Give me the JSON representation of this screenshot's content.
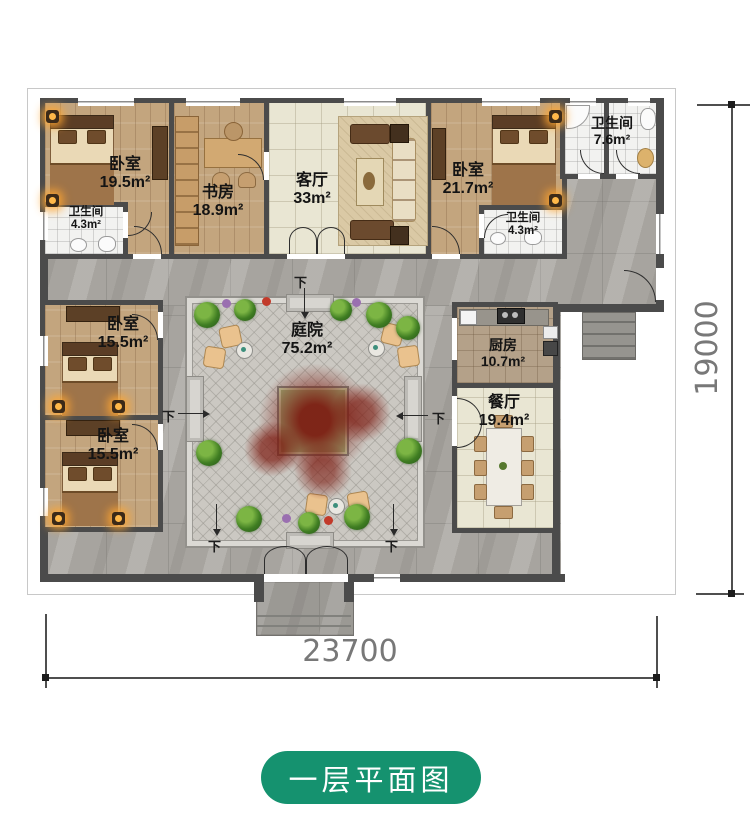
{
  "title_badge": {
    "text": "一层平面图"
  },
  "dimensions": {
    "width_label": "23700",
    "height_label": "19000"
  },
  "step_label": "下",
  "rooms": {
    "bedroom_nw": {
      "name": "卧室",
      "area": "19.5m²"
    },
    "bath_nw": {
      "name": "卫生间",
      "area": "4.3m²"
    },
    "study": {
      "name": "书房",
      "area": "18.9m²"
    },
    "living": {
      "name": "客厅",
      "area": "33m²"
    },
    "bedroom_ne": {
      "name": "卧室",
      "area": "21.7m²"
    },
    "bath_inner": {
      "name": "卫生间",
      "area": "4.3m²"
    },
    "bath_ne": {
      "name": "卫生间",
      "area": "7.6m²"
    },
    "bedroom_w1": {
      "name": "卧室",
      "area": "15.5m²"
    },
    "bedroom_w2": {
      "name": "卧室",
      "area": "15.5m²"
    },
    "courtyard": {
      "name": "庭院",
      "area": "75.2m²"
    },
    "kitchen": {
      "name": "厨房",
      "area": "10.7m²"
    },
    "dining": {
      "name": "餐厅",
      "area": "19.4m²"
    }
  },
  "colors": {
    "badge_green": "#15926f",
    "wall_gray": "#4b4b4b",
    "tree_red": "#7c1a10"
  }
}
